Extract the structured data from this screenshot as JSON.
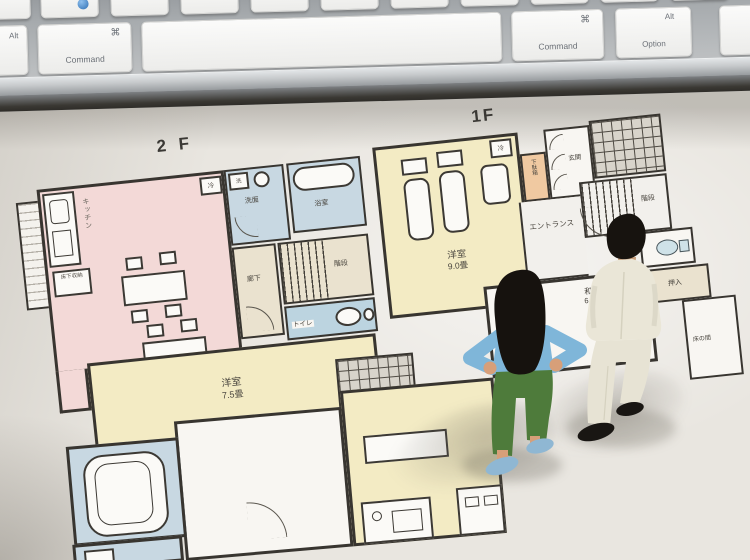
{
  "scene": {
    "description": "Two miniature figurines standing on printed Japanese house floor plans placed on a desk in front of a computer keyboard"
  },
  "keyboard": {
    "left_option_partial": {
      "top": "Alt",
      "bottom": "tion"
    },
    "left_command": {
      "symbol": "⌘",
      "label": "Command"
    },
    "right_command": {
      "symbol": "⌘",
      "label": "Command"
    },
    "right_option": {
      "top": "Alt",
      "bottom": "Option"
    }
  },
  "floorplan_2f": {
    "title": "2 F",
    "labels": {
      "kitchen": "キッチン",
      "underfloor_storage": "床下収納",
      "fridge": "冷",
      "washer": "洗",
      "washroom": "洗面",
      "bathroom": "浴室",
      "hallway": "廊下",
      "stairs": "階段",
      "toilet": "トイレ",
      "bedroom": "洋室",
      "bedroom_size": "7.5畳"
    }
  },
  "floorplan_1f": {
    "title": "1F",
    "labels": {
      "bedroom": "洋室",
      "bedroom_size": "9.0畳",
      "fridge": "冷",
      "shoe_cabinet": "下駄箱",
      "entry": "玄関",
      "entrance_hall": "エントランス",
      "stairs": "階段",
      "closet": "押入",
      "japanese_room": "和室",
      "japanese_room_size": "6.0畳",
      "alcove": "床の間"
    }
  },
  "figurines": {
    "woman": {
      "top_color": "#7fb6d9",
      "pants_color": "#4e7b3b",
      "hair_color": "#16120e",
      "shoes_color": "#8fb7d3"
    },
    "man": {
      "suit_color": "#eae6d7",
      "hair_color": "#17130f",
      "shoes_color": "#191613"
    }
  },
  "colors": {
    "ldk_pink": "#f3d9d7",
    "bedroom_yellow": "#f3ebc4",
    "bath_blue": "#c8d8e2",
    "hall_beige": "#eae2cf",
    "shoe_cabinet_orange": "#f0c9a1",
    "wall": "#383530",
    "paper": "#e9e6e0",
    "keyboard_key": "#f4f4f2"
  }
}
